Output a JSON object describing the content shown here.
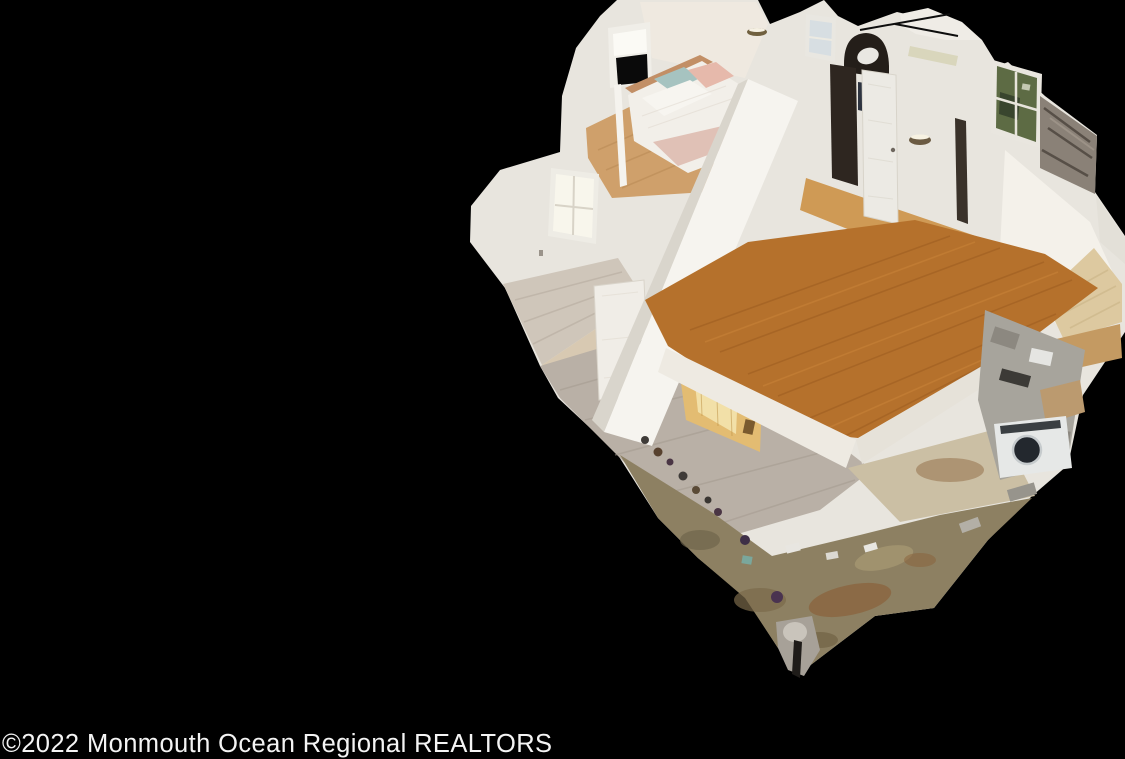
{
  "image": {
    "kind": "real-estate-3d-dollhouse-scan",
    "description": "Aerial cutaway dollhouse view of a two-story house interior scan, floating on a solid black background",
    "width_px": 1125,
    "height_px": 759
  },
  "watermark": {
    "text": "©2022 Monmouth Ocean Regional REALTORS",
    "color": "#f4f4f4"
  },
  "scene": {
    "visible_rooms": [
      "upstairs bedroom with dressed bed",
      "upstairs hallway with paneled doors and arched opening",
      "large empty bonus room with orange hardwood floor",
      "side room with window and gray-washed wood floor",
      "first floor with kitchen glow",
      "cluttered unfinished basement with washer"
    ],
    "visible_objects": [
      "bed with white and blush bedding",
      "white paneled interior doors",
      "arched wall opening",
      "wall sconce lights",
      "window with greenery outside",
      "weathered chimney wall",
      "front-load washing machine",
      "scan debris and clutter",
      "white scan artifact blob"
    ]
  },
  "palette": {
    "background": "#000000",
    "wall_white": "#e8e5de",
    "wall_bright": "#f6f4ef",
    "hardwood_orange": "#b5712c",
    "hall_floor": "#cf9a55",
    "bedroom_floor": "#cfa06b",
    "gray_wood": "#b9b0a6",
    "pale_wood": "#ddc9a0",
    "basement_floor": "#8d8062",
    "kitchen_glow": "#e3bc72",
    "chimney_gray": "#8a8177",
    "window_greenery": "#5d6b44",
    "bed_linen": "#f2efe9",
    "blush_blanket": "#e0c1b6"
  }
}
